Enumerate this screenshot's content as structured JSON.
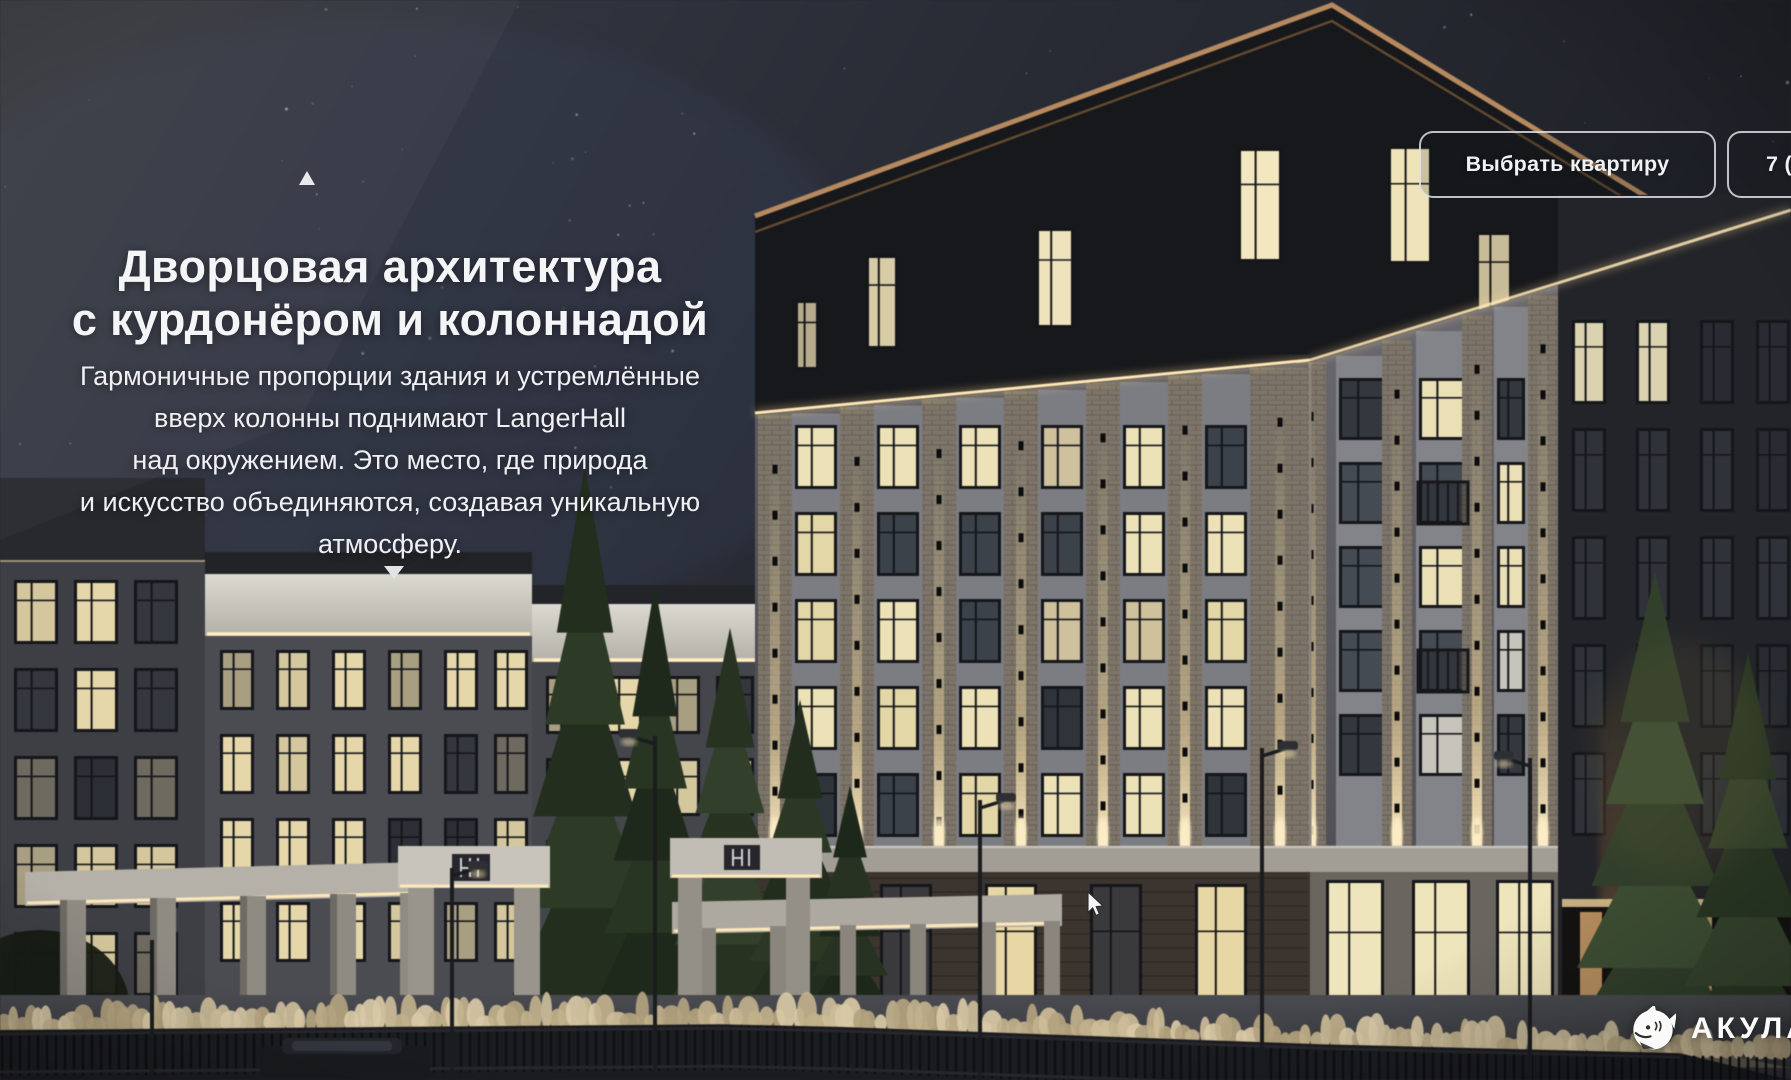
{
  "hero": {
    "title_lines": [
      "Дворцовая архитектура",
      "с курдонёром и колоннадой"
    ],
    "body_lines": [
      "Гармоничные пропорции здания и устремлённые",
      "вверх колонны поднимают LangerHall",
      "над окружением. Это место, где природа",
      "и искусство объединяются, создавая уникальную",
      "атмосферу."
    ]
  },
  "header": {
    "choose_apartment_label": "Выбрать квартиру",
    "phone_partial": "7 ("
  },
  "brand": {
    "name": "АКУЛА"
  },
  "colors": {
    "accent_copper": "#b9895c",
    "text": "#f2f3f5",
    "sky_navy": "#2c3040",
    "window_lit": "#ece0b2"
  }
}
